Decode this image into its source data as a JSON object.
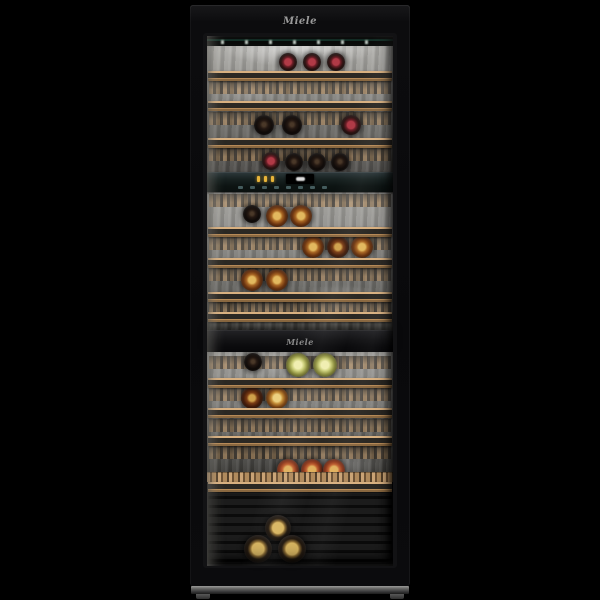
{
  "brand": {
    "top_logo": "Miele",
    "divider_logo": "Miele"
  },
  "colors": {
    "background": "#000000",
    "door_black": "#0b0b0c",
    "shelf_wood": "#c9a274",
    "interior_metal": "#8a8985",
    "control_panel": "#14201f",
    "indicator_amber": "#e8b43a",
    "touch_icon_teal": "#a0d2d7",
    "led_white": "#eafff2",
    "red_capsule": "#b03a46",
    "amber_wine": "#a86624",
    "white_wine": "#cccf7a",
    "rose_wine": "#c06030",
    "gold_foil": "#d8b560",
    "plinth_metal": "#8a8a8a"
  },
  "control_panel": {
    "indicators": [
      "temp-segment-1",
      "temp-segment-2",
      "temp-segment-3"
    ],
    "touch_icons": [
      "touch-key-1",
      "touch-key-2",
      "touch-key-3",
      "touch-key-4",
      "touch-key-5",
      "touch-key-6",
      "touch-key-7",
      "touch-key-8"
    ]
  },
  "shelves": {
    "rails_y": [
      71,
      101,
      138,
      227,
      258,
      292,
      312,
      378,
      408,
      436,
      482
    ],
    "decks_y": [
      81,
      112,
      148,
      194,
      237,
      268,
      302,
      356,
      388,
      419,
      446
    ]
  },
  "bottles": [
    {
      "x": 288,
      "y": 62,
      "r": 9,
      "style": "dark-red"
    },
    {
      "x": 312,
      "y": 62,
      "r": 9,
      "style": "dark-red"
    },
    {
      "x": 336,
      "y": 62,
      "r": 9,
      "style": "dark-red"
    },
    {
      "x": 264,
      "y": 125,
      "r": 10,
      "style": "dark"
    },
    {
      "x": 292,
      "y": 125,
      "r": 10,
      "style": "dark"
    },
    {
      "x": 351,
      "y": 125,
      "r": 10,
      "style": "dark-red"
    },
    {
      "x": 271,
      "y": 161,
      "r": 9,
      "style": "dark-red"
    },
    {
      "x": 294,
      "y": 162,
      "r": 9,
      "style": "dark"
    },
    {
      "x": 317,
      "y": 162,
      "r": 9,
      "style": "dark"
    },
    {
      "x": 340,
      "y": 162,
      "r": 9,
      "style": "dark"
    },
    {
      "x": 252,
      "y": 214,
      "r": 9,
      "style": "dark"
    },
    {
      "x": 277,
      "y": 216,
      "r": 11,
      "style": "amber"
    },
    {
      "x": 301,
      "y": 216,
      "r": 11,
      "style": "amber"
    },
    {
      "x": 313,
      "y": 247,
      "r": 11,
      "style": "amber"
    },
    {
      "x": 338,
      "y": 247,
      "r": 11,
      "style": "amber-dark"
    },
    {
      "x": 362,
      "y": 247,
      "r": 11,
      "style": "amber"
    },
    {
      "x": 252,
      "y": 280,
      "r": 11,
      "style": "amber"
    },
    {
      "x": 277,
      "y": 280,
      "r": 11,
      "style": "amber"
    },
    {
      "x": 253,
      "y": 362,
      "r": 9,
      "style": "dark"
    },
    {
      "x": 298,
      "y": 365,
      "r": 12,
      "style": "white"
    },
    {
      "x": 325,
      "y": 365,
      "r": 12,
      "style": "white"
    },
    {
      "x": 252,
      "y": 398,
      "r": 11,
      "style": "amber-dark"
    },
    {
      "x": 277,
      "y": 398,
      "r": 11,
      "style": "amber-light"
    },
    {
      "x": 288,
      "y": 470,
      "r": 11,
      "style": "rose"
    },
    {
      "x": 312,
      "y": 470,
      "r": 11,
      "style": "rose"
    },
    {
      "x": 334,
      "y": 470,
      "r": 11,
      "style": "rose"
    },
    {
      "x": 278,
      "y": 528,
      "r": 13,
      "style": "cellar"
    },
    {
      "x": 258,
      "y": 549,
      "r": 14,
      "style": "cellar"
    },
    {
      "x": 292,
      "y": 549,
      "r": 14,
      "style": "cellar"
    }
  ]
}
